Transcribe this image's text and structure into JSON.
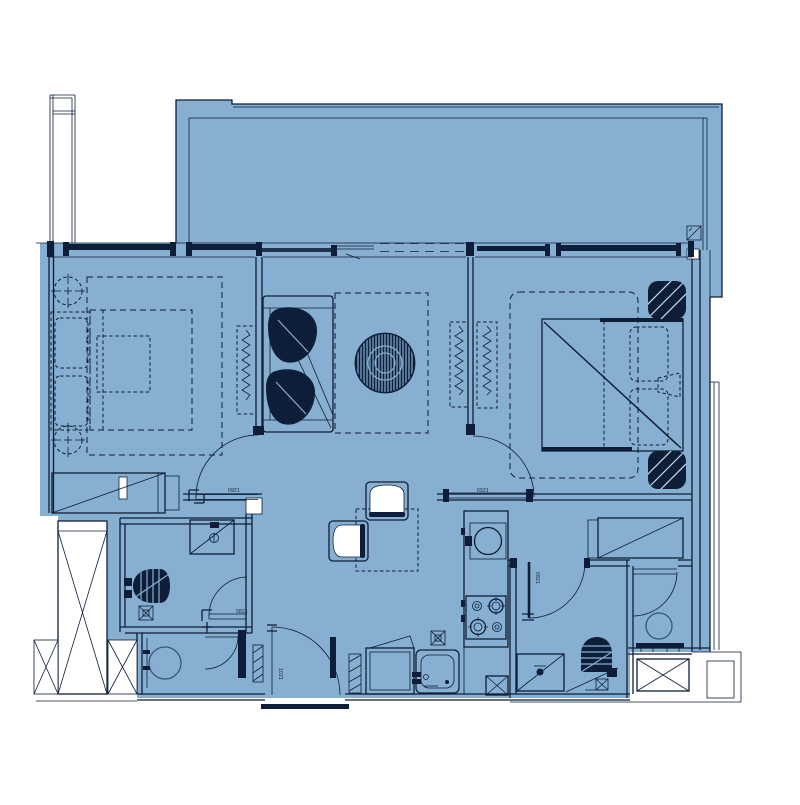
{
  "plan": {
    "kind": "apartment-floor-plan",
    "colors": {
      "floor_fill": "#87AFD1",
      "line_dark": "#0E1E38",
      "line_mid": "#33567C",
      "stripe": "#C9DCEC",
      "white": "#FFFFFF"
    }
  },
  "door_labels": [
    {
      "text": "0921"
    },
    {
      "text": "0921"
    },
    {
      "text": "0821"
    },
    {
      "text": "0821"
    },
    {
      "text": "1021"
    }
  ]
}
